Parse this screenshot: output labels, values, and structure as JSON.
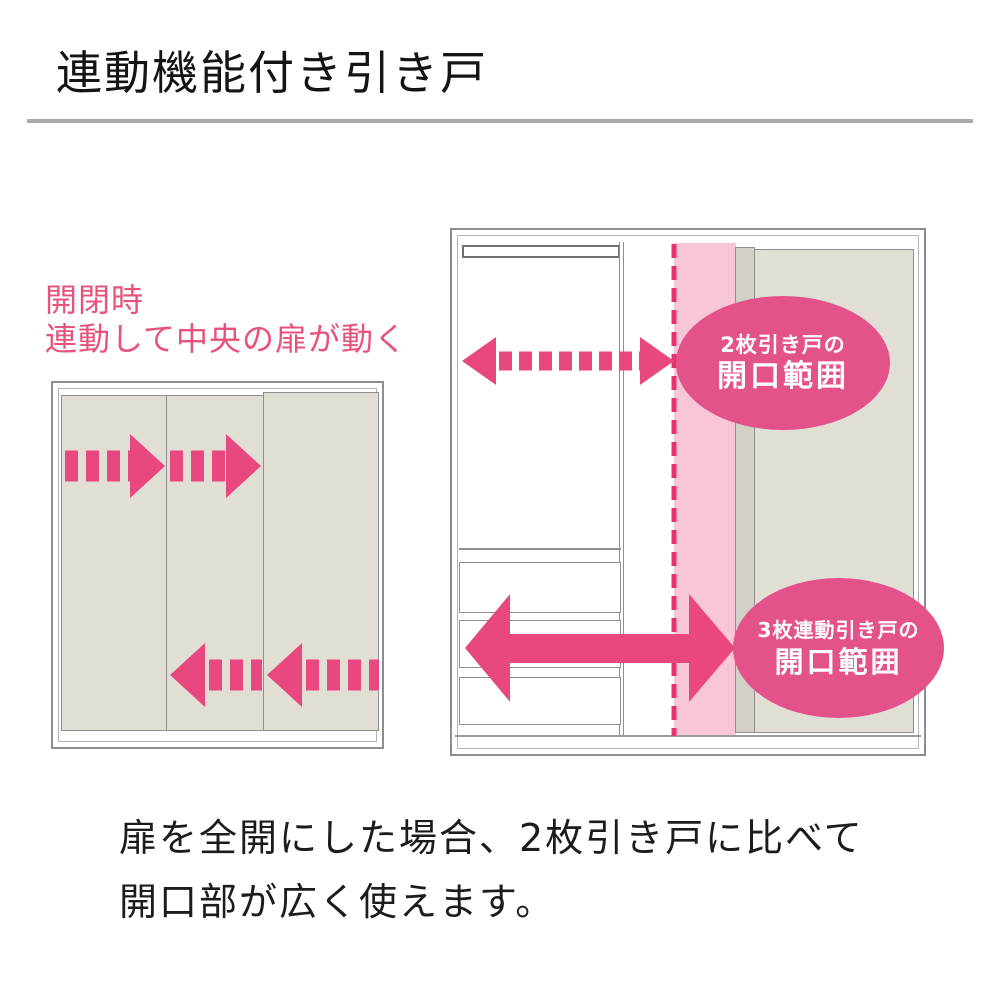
{
  "header": {
    "title": "連動機能付き引き戸"
  },
  "caption": {
    "line1": "開閉時",
    "line2": "連動して中央の扉が動く"
  },
  "right_diagram": {
    "badge_two_panel": {
      "line1": "2枚引き戸の",
      "line2": "開口範囲"
    },
    "badge_three_panel": {
      "line1": "3枚連動引き戸の",
      "line2": "開口範囲"
    }
  },
  "footer": {
    "line1": "扉を全開にした場合、2枚引き戸に比べて",
    "line2": "開口部が広く使えます。"
  },
  "colors": {
    "accent_pink": "#e8487e",
    "badge_pink": "#e4528a",
    "band_pink": "#f8c6d6",
    "dashed_line_pink": "#ea316f",
    "caption_pink": "#e8537c",
    "door_beige": "#e1ded6",
    "rule_gray": "#ababab"
  }
}
